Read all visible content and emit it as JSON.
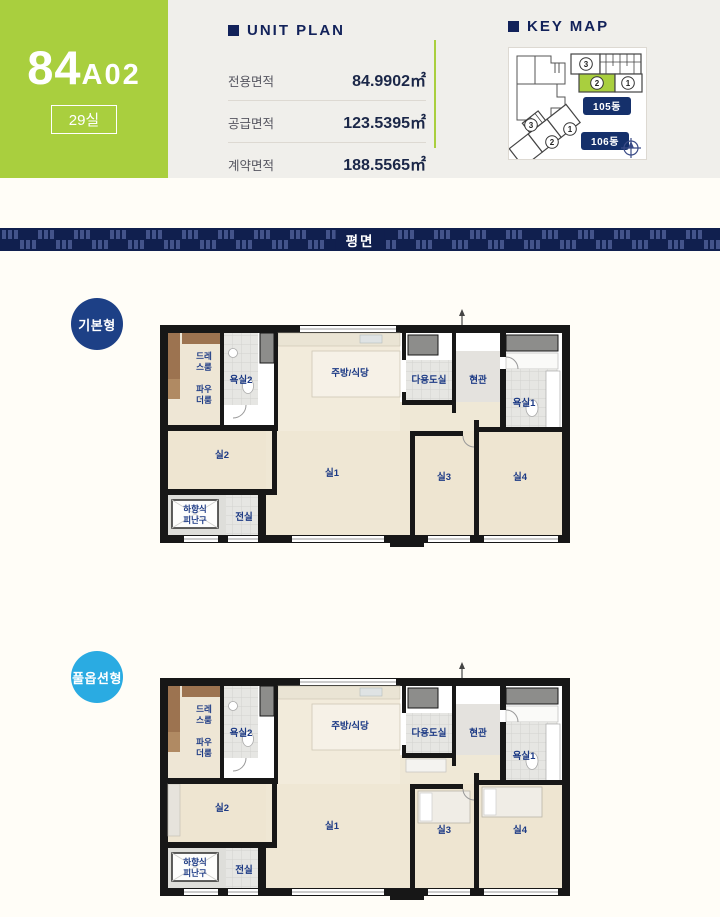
{
  "unit_header": {
    "code_main": "84",
    "code_sub": "A02",
    "badge": "29실"
  },
  "unit_plan": {
    "title": "UNIT PLAN",
    "rows": [
      {
        "label": "전용면적",
        "value": "84.9902㎡"
      },
      {
        "label": "공급면적",
        "value": "123.5395㎡"
      },
      {
        "label": "계약면적",
        "value": "188.5565㎡"
      }
    ]
  },
  "key_map": {
    "title": "KEY MAP",
    "buildings": [
      {
        "label": "105동",
        "units": [
          "3",
          "2",
          "1"
        ],
        "highlighted_unit": "2"
      },
      {
        "label": "106동",
        "units": [
          "3",
          "2",
          "1"
        ]
      }
    ],
    "icons": {
      "compass": "compass-icon"
    }
  },
  "section_banner": {
    "title": "평면"
  },
  "plans": [
    {
      "type_label": "기본형",
      "badge_color": "#1d4086"
    },
    {
      "type_label": "풀옵션형",
      "badge_color": "#2aabe2"
    }
  ],
  "rooms": {
    "dress_line1": "드레",
    "dress_line2": "스룸",
    "powder_line1": "파우",
    "powder_line2": "더룸",
    "bath2": "욕실2",
    "kitchen": "주방/식당",
    "utility": "다용도실",
    "entrance": "현관",
    "bath1": "욕실1",
    "room2": "실2",
    "room1": "실1",
    "room3": "실3",
    "room4": "실4",
    "hatch_line1": "하향식",
    "hatch_line2": "피난구",
    "vestibule": "전실"
  },
  "colors": {
    "accent_green": "#a9cf3e",
    "navy_text": "#12225a",
    "banner_navy": "#101f4e",
    "basic_badge": "#1d4086",
    "full_option_badge": "#2aabe2",
    "room_label_blue": "#1c3a85",
    "header_band_bg": "#f0efeb",
    "page_bg": "#fffdf7"
  }
}
